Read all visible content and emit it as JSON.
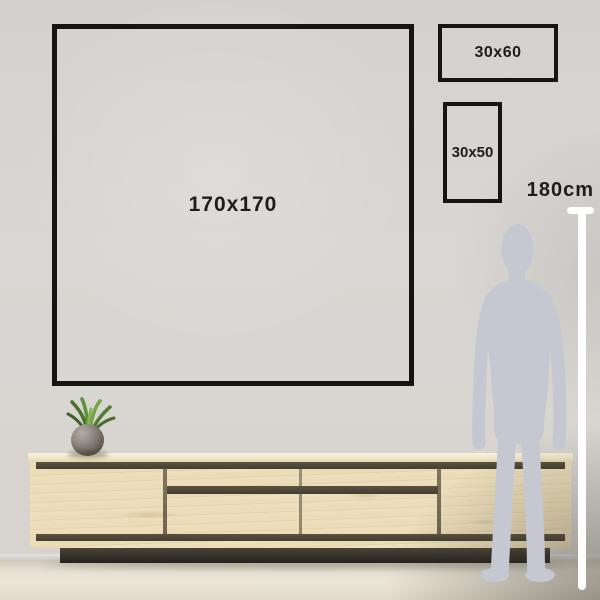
{
  "scene": {
    "type": "wall-art-size-guide",
    "sizes": {
      "large": "170x170",
      "wide": "30x60",
      "tall": "30x50"
    },
    "reference_height": "180cm"
  },
  "graphics": {
    "person": "standing-man-silhouette",
    "ruler": "white-vertical-measure-line",
    "furniture": "wooden-sideboard-with-drawers",
    "plant": "potted-grass-plant"
  },
  "colors": {
    "frame_border": "#161511",
    "label_text": "#1e1d1b",
    "wall": "#d7d5d1",
    "floor": "#e7e2d4",
    "wood": "#ecddb8",
    "wood_top": "#f1e6c8",
    "groove": "#4e4837",
    "plinth": "#2e2b23",
    "silhouette": "#c5c8d1",
    "measure_line": "#ffffff",
    "plant_green": "#628f3c",
    "pot": "#6e6860"
  }
}
